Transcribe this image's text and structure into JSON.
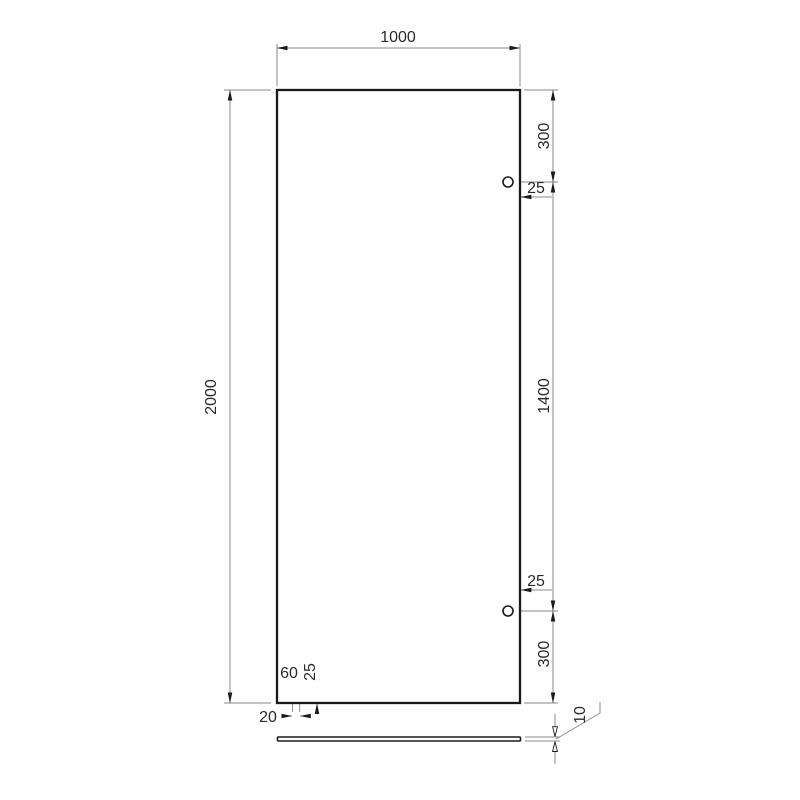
{
  "drawing": {
    "kind": "glass-panel-technical-drawing",
    "panel": {
      "width": "1000",
      "height": "2000"
    },
    "holes": {
      "top_offset_from_top": "300",
      "top_offset_from_edge": "25",
      "center_spacing": "1400",
      "bottom_offset_from_edge": "25",
      "bottom_offset_from_bottom": "300"
    },
    "slot": {
      "offset_from_left": "60",
      "height_from_bottom": "25",
      "width": "20"
    },
    "profile": {
      "thickness": "10"
    }
  },
  "colors": {
    "background": "#ffffff",
    "outline": "#1a1a1a",
    "dimension_lines": "#8a8a8a",
    "dimension_text": "#2a2a2a"
  }
}
